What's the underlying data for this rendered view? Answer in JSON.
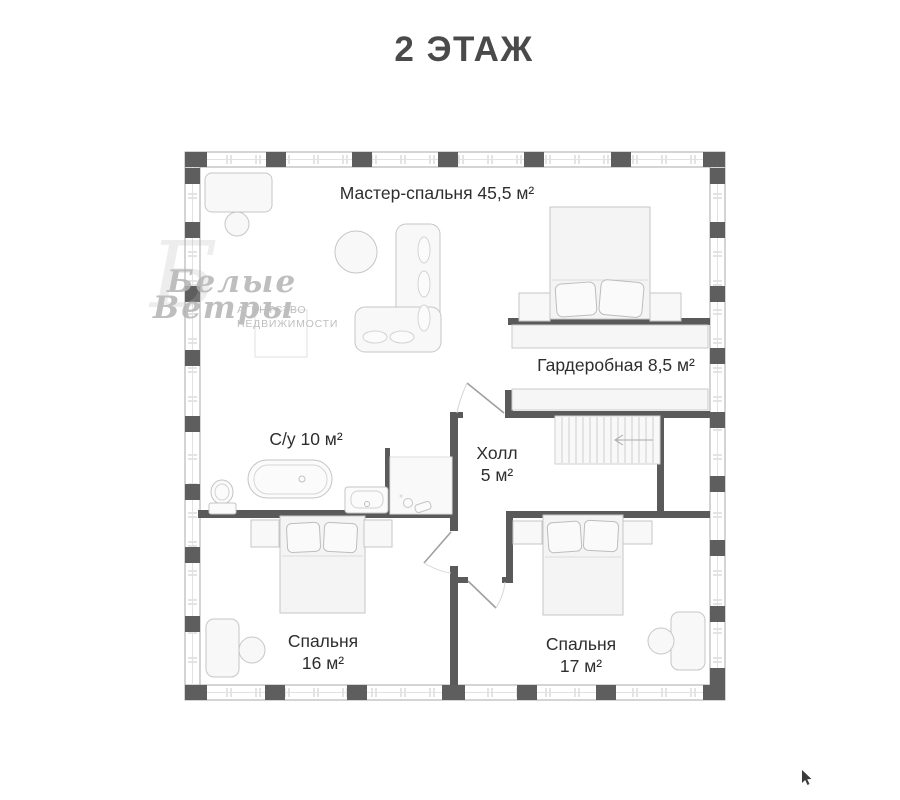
{
  "page": {
    "title": "2 ЭТАЖ"
  },
  "rooms": {
    "master": {
      "label": "Мастер-спальня 45,5 м²",
      "name": "Мастер-спальня",
      "area": "45,5 м²"
    },
    "wardrobe": {
      "label": "Гардеробная 8,5 м²",
      "name": "Гардеробная",
      "area": "8,5 м²"
    },
    "bathroom": {
      "label": "С/у 10 м²",
      "name": "С/у",
      "area": "10 м²"
    },
    "hall": {
      "name": "Холл",
      "area": "5 м²"
    },
    "bedroom16": {
      "name": "Спальня",
      "area": "16 м²"
    },
    "bedroom17": {
      "name": "Спальня",
      "area": "17 м²"
    }
  },
  "watermark": {
    "brand1": "Белые",
    "brand2": "Ветры",
    "brand_initial": "Б",
    "agency1": "АГЕНТСТВО",
    "agency2": "НЕДВИЖИМОСТИ"
  },
  "colors": {
    "title_text": "#4a4a4a",
    "label_text": "#2e2e2e",
    "wall_dark": "#5a5a5a",
    "wall_light_line": "#a8a8a8",
    "furniture_stroke": "#c6c6c6",
    "furniture_fill": "#f6f6f6",
    "watermark": "#b3b3b3"
  }
}
